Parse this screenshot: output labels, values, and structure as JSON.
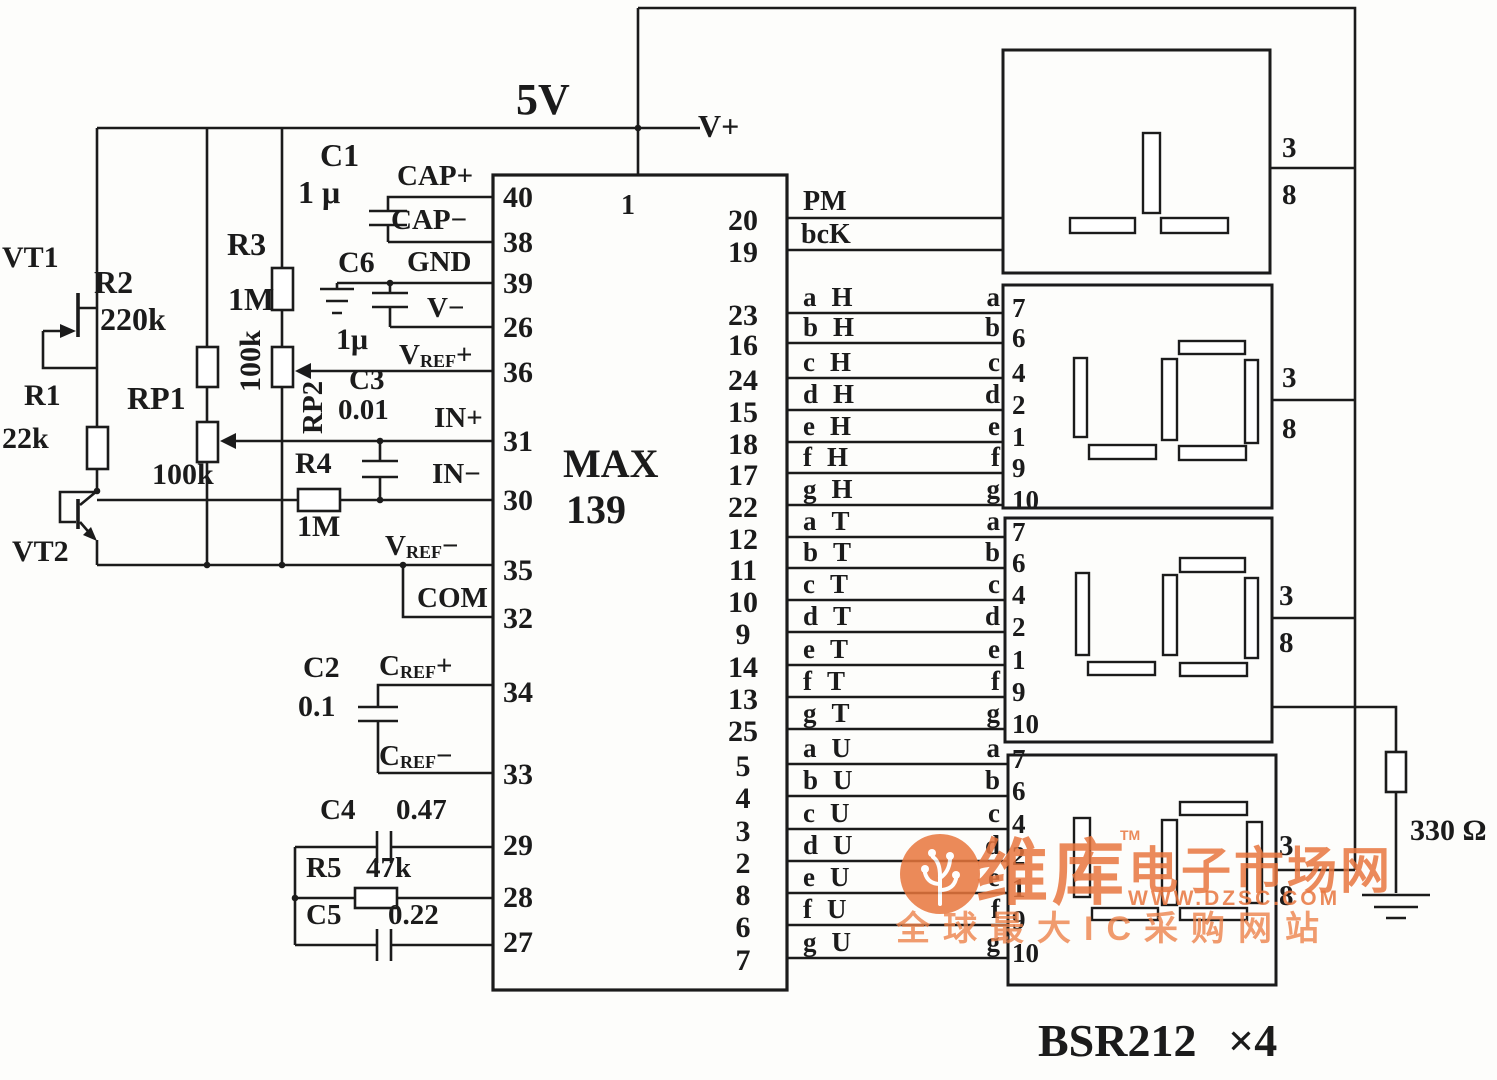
{
  "power": {
    "rail": "5V",
    "vplus": "V+",
    "resistor_330": "330 Ω"
  },
  "transistors": {
    "vt1": "VT1",
    "vt2": "VT2"
  },
  "resistors": {
    "r1": {
      "name": "R1",
      "value": "22k"
    },
    "r2": {
      "name": "R2",
      "value": "220k"
    },
    "r3": {
      "name": "R3",
      "value": "1M"
    },
    "rp1": {
      "name": "RP1",
      "value": "100k"
    },
    "rp2": {
      "name": "RP2",
      "value": "100k"
    },
    "r4": {
      "name": "R4",
      "value": "1M"
    },
    "r5": {
      "name": "R5",
      "value": "47k"
    }
  },
  "capacitors": {
    "c1": {
      "name": "C1",
      "value": "1 μ"
    },
    "c2": {
      "name": "C2",
      "value": "0.1"
    },
    "c3": {
      "name": "C3",
      "value": "0.01"
    },
    "c4": {
      "name": "C4",
      "value": "0.47"
    },
    "c5": {
      "name": "C5",
      "value": "0.22"
    },
    "c6": {
      "name": "C6",
      "value": "1μ"
    }
  },
  "ic": {
    "part_line1": "MAX",
    "part_line2": "139",
    "pin1": "1",
    "left_pins": [
      {
        "num": "40",
        "label": "CAP+"
      },
      {
        "num": "38",
        "label": "CAP−"
      },
      {
        "num": "39",
        "label": "GND"
      },
      {
        "num": "26",
        "label": "V−"
      },
      {
        "num": "36",
        "base": "V",
        "sub": "REF",
        "sign": "+"
      },
      {
        "num": "31",
        "label": "IN+"
      },
      {
        "num": "30",
        "label": "IN−"
      },
      {
        "num": "35",
        "base": "V",
        "sub": "REF",
        "sign": "−"
      },
      {
        "num": "32",
        "label": "COM"
      },
      {
        "num": "34",
        "base": "C",
        "sub": "REF",
        "sign": "+"
      },
      {
        "num": "33",
        "base": "C",
        "sub": "REF",
        "sign": "−"
      },
      {
        "num": "29"
      },
      {
        "num": "28"
      },
      {
        "num": "27"
      }
    ],
    "right_pins": [
      {
        "num": "20",
        "label": "PM"
      },
      {
        "num": "19",
        "label": "bcK"
      },
      {
        "num": "23",
        "seg": "a",
        "grp": "H"
      },
      {
        "num": "16",
        "seg": "b",
        "grp": "H"
      },
      {
        "num": "24",
        "seg": "c",
        "grp": "H"
      },
      {
        "num": "15",
        "seg": "d",
        "grp": "H"
      },
      {
        "num": "18",
        "seg": "e",
        "grp": "H"
      },
      {
        "num": "17",
        "seg": "f",
        "grp": "H"
      },
      {
        "num": "22",
        "seg": "g",
        "grp": "H"
      },
      {
        "num": "12",
        "seg": "a",
        "grp": "T"
      },
      {
        "num": "11",
        "seg": "b",
        "grp": "T"
      },
      {
        "num": "10",
        "seg": "c",
        "grp": "T"
      },
      {
        "num": "9",
        "seg": "d",
        "grp": "T"
      },
      {
        "num": "14",
        "seg": "e",
        "grp": "T"
      },
      {
        "num": "13",
        "seg": "f",
        "grp": "T"
      },
      {
        "num": "25",
        "seg": "g",
        "grp": "T"
      },
      {
        "num": "5",
        "seg": "a",
        "grp": "U"
      },
      {
        "num": "4",
        "seg": "b",
        "grp": "U"
      },
      {
        "num": "3",
        "seg": "c",
        "grp": "U"
      },
      {
        "num": "2",
        "seg": "d",
        "grp": "U"
      },
      {
        "num": "8",
        "seg": "e",
        "grp": "U"
      },
      {
        "num": "6",
        "seg": "f",
        "grp": "U"
      },
      {
        "num": "7",
        "seg": "g",
        "grp": "U"
      }
    ]
  },
  "displays": {
    "part": "BSR212",
    "multiplier": "×4",
    "common_top": "3",
    "common_bottom": "8",
    "left_pin_numbers": [
      "7",
      "6",
      "4",
      "2",
      "1",
      "9",
      "10"
    ]
  },
  "watermark": {
    "brand": "维库",
    "tm": "TM",
    "suffix": "电子市场网",
    "url": "WWW.DZSC.COM",
    "tagline": "全球最大IC采购网站"
  },
  "colors": {
    "line": "#1b1b1b",
    "watermark_orange": "#e8763d"
  }
}
